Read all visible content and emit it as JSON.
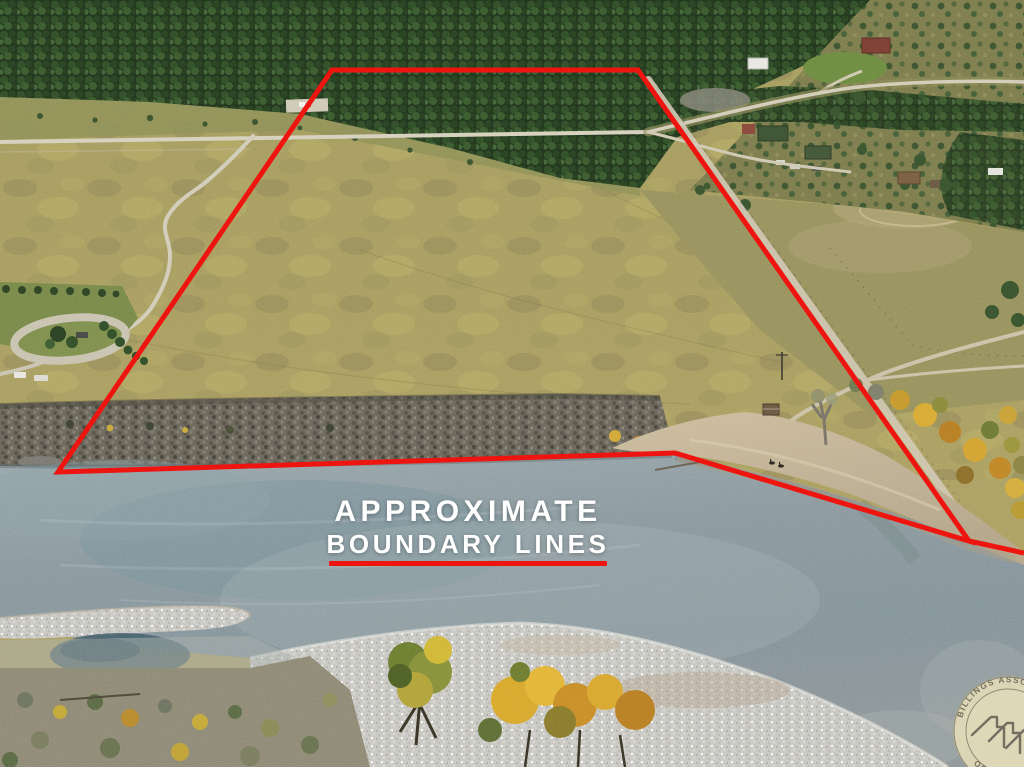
{
  "annotation": {
    "line1": "APPROXIMATE",
    "line2": "BOUNDARY LINES"
  },
  "watermark": {
    "arc_top": "BILLINGS ASSOCIATION",
    "arc_bottom": "OF REALTORS"
  },
  "colors": {
    "boundary_red": "#ee1510",
    "annotation_white": "#ffffff",
    "watermark_beige": "#e9e0ba"
  }
}
